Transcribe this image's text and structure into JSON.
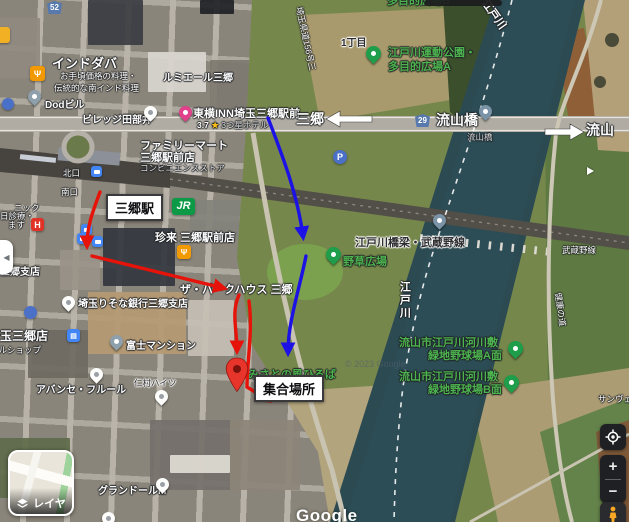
{
  "colors": {
    "annotation_red": "#e51309",
    "annotation_blue": "#1c12e6",
    "park_label_green": "#4db34f",
    "water": "#2c4a52",
    "control_bg": "#1f2023",
    "pegman_orange": "#f9a825"
  },
  "icons": {
    "sidebar_collapse": "chevron-left-icon",
    "layers": "layers-diamond-icon",
    "my_location": "target-icon",
    "zoom_in": "plus-icon",
    "zoom_out": "minus-icon",
    "pegman": "person-icon",
    "restaurant": "fork-knife-icon",
    "hotel": "bed-icon",
    "parking": "letter-P-icon",
    "hospital": "letter-H-icon",
    "bus": "bus-icon",
    "rail": "jr-logo",
    "park": "tree-icon",
    "bridge": "bridge-icon"
  },
  "t": {
    "indotaba": "インドダバ",
    "indotaba_sub1": "お手頃価格の料理・",
    "indotaba_sub2": "伝統的な南インド料理",
    "lumiere": "ルミエール三郷",
    "dod": "Dodビル",
    "village": "ビレッジ田部井",
    "toyoko": "東横INN埼玉三郷駅前",
    "rating": "3.7",
    "star": "★",
    "hotel_type": "3つ星ホテル",
    "fam1": "ファミリーマート",
    "fam2": "三郷駅前店",
    "fam3": "コンビニエンスストア",
    "misato": "三郷",
    "r52": "52",
    "r29": "29",
    "nagareyamabashi": "流山橋",
    "nagareyamabashi_sm": "流山橋",
    "nagareyama": "流山",
    "parkA1": "江戸川運動公園・",
    "parkA2": "多目的広場A",
    "parkB": "多目的広場B",
    "itchome": "1丁目",
    "prefroad": "埼玉県道156号三",
    "edogawa": "江戸川",
    "kitaguchi": "北口",
    "minamiguchi": "南口",
    "misatoeki": "三郷駅",
    "jr": "JR",
    "clinic1": "ニック",
    "clinic2": "日診療・",
    "clinic3": "ます",
    "hh": "H",
    "chinrai": "珍来 三郷駅前店",
    "parkhouse": "ザ・パークハウス 三郷",
    "yasou": "野草広場",
    "railbridge": "江戸川橋梁・武蔵野線",
    "musashino": "武蔵野線",
    "kenko": "健康の道",
    "ballA1": "流山市江戸川河川敷",
    "ballA2": "緑地野球場A面",
    "ballB1": "流山市江戸川河川敷",
    "ballB2": "緑地野球場B面",
    "kaze": "みさとの風ひろば",
    "meeting": "集合場所",
    "risona": "埼玉りそな銀行三郷支店",
    "bank": "銀行三郷支店",
    "store1": "埼玉三郷店",
    "store2": "フルショップ",
    "fuji": "富士マンション",
    "nimura": "仁村ハイツ",
    "avance": "アバンセ・フルール",
    "grandor": "グランドールM",
    "sanv": "サンヴェール",
    "pp": "P",
    "copyright": "© 2023 Google",
    "google": "Google",
    "layers": "レイヤ",
    "zin": "+",
    "zout": "−",
    "collapse": "◀"
  }
}
